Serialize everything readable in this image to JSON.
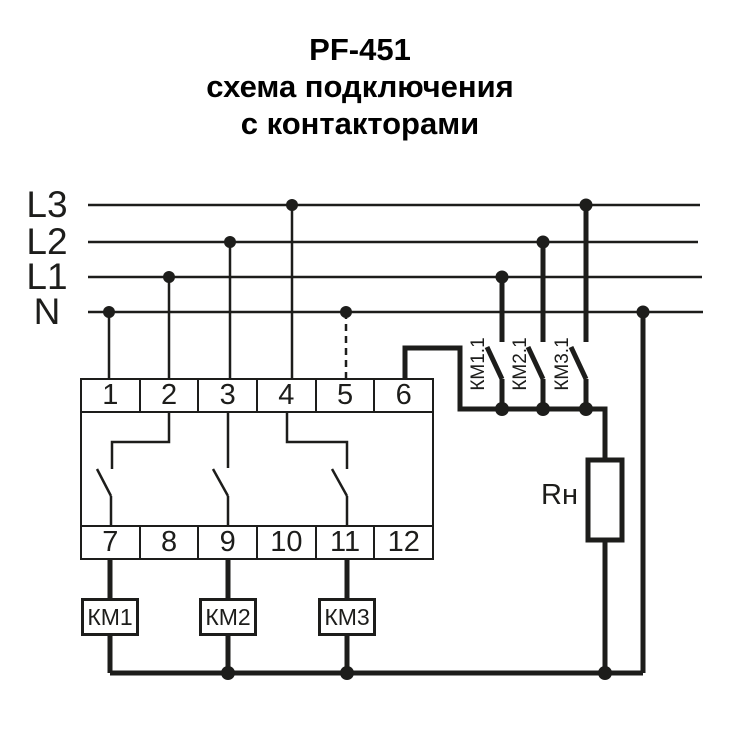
{
  "title": {
    "line1": "PF-451",
    "line2": "схема подключения",
    "line3": "с контакторами"
  },
  "power_lines": {
    "l3": "L3",
    "l2": "L2",
    "l1": "L1",
    "n": "N"
  },
  "relay": {
    "terminals_top": [
      "1",
      "2",
      "3",
      "4",
      "5",
      "6"
    ],
    "terminals_bottom": [
      "7",
      "8",
      "9",
      "10",
      "11",
      "12"
    ]
  },
  "contactors": {
    "coils": [
      "КМ1",
      "КМ2",
      "КМ3"
    ],
    "contacts": [
      "КМ1.1",
      "КМ2.1",
      "КМ3.1"
    ]
  },
  "load": {
    "label": "Rн"
  },
  "colors": {
    "ink": "#1d1d1b",
    "background": "#ffffff"
  }
}
